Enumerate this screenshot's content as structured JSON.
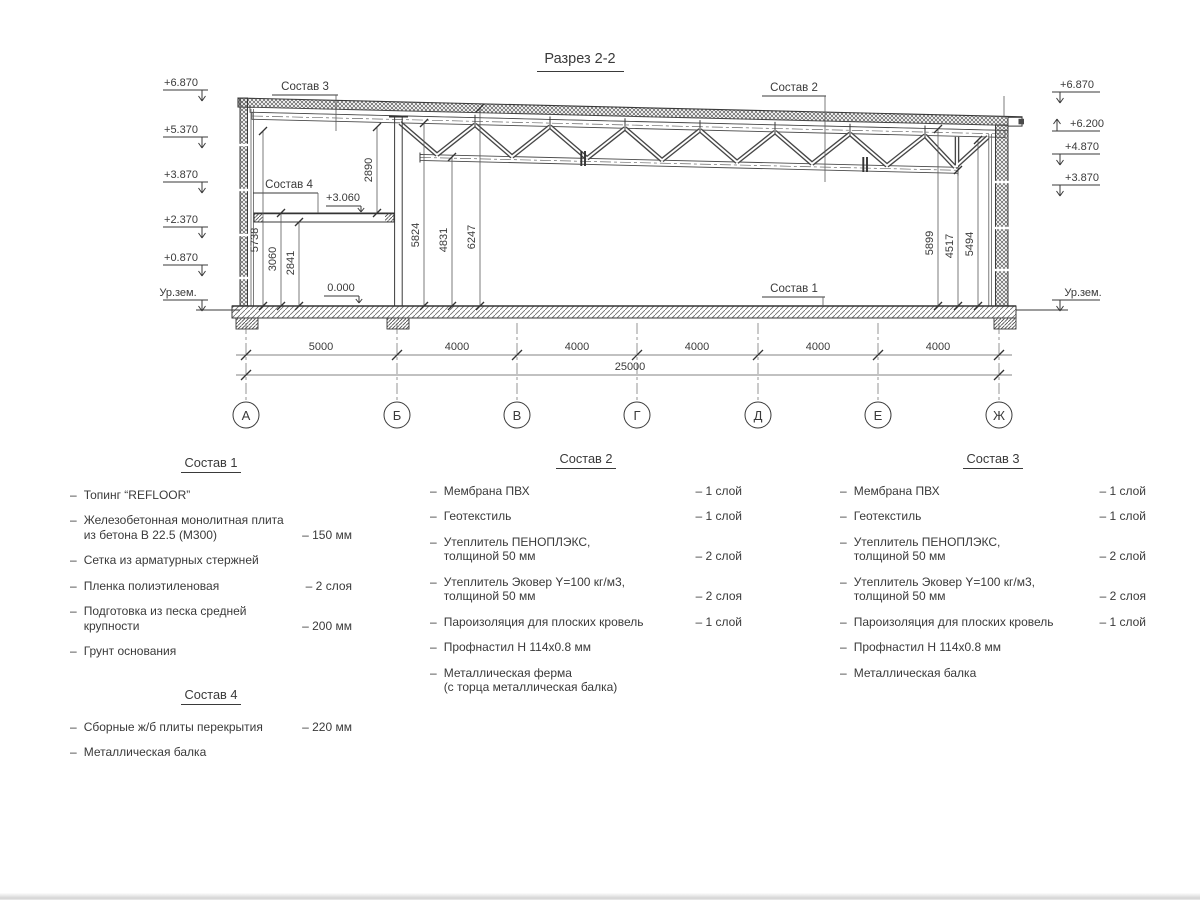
{
  "bullet": "–",
  "drawing": {
    "title": "Разрез 2-2",
    "elev_left": [
      "+6.870",
      "+5.370",
      "+3.870",
      "+2.370",
      "+0.870",
      "Ур.зем."
    ],
    "elev_right": [
      "+6.870",
      "+6.200",
      "+4.870",
      "+3.870",
      "Ур.зем."
    ],
    "inner_levels": [
      "+3.060",
      "0.000"
    ],
    "leaders": [
      "Состав 3",
      "Состав 4",
      "Состав 2",
      "Состав 1"
    ],
    "vdims": [
      "5738",
      "3060",
      "2841",
      "2890",
      "5824",
      "4831",
      "6247",
      "5899",
      "4517",
      "5494"
    ],
    "hdims": [
      "5000",
      "4000",
      "4000",
      "4000",
      "4000",
      "4000"
    ],
    "total_dim": "25000",
    "axes": [
      "А",
      "Б",
      "В",
      "Г",
      "Д",
      "Е",
      "Ж"
    ]
  },
  "compositions": [
    {
      "title": "Состав 1",
      "items": [
        {
          "text": "Топинг “REFLOOR”",
          "value": ""
        },
        {
          "text": "Железобетонная  монолитная плита\nиз бетона В 22.5 (М300)",
          "value": "– 150 мм"
        },
        {
          "text": "Сетка из арматурных стержней",
          "value": ""
        },
        {
          "text": "Пленка полиэтиленовая",
          "value": "– 2 слоя"
        },
        {
          "text": "Подготовка из песка средней\nкрупности",
          "value": "– 200 мм"
        },
        {
          "text": "Грунт основания",
          "value": ""
        }
      ]
    },
    {
      "title": "Состав 2",
      "items": [
        {
          "text": "Мембрана ПВХ",
          "value": "– 1 слой"
        },
        {
          "text": "Геотекстиль",
          "value": "– 1 слой"
        },
        {
          "text": "Утеплитель ПЕНОПЛЭКС,\nтолщиной 50 мм",
          "value": "– 2 слой"
        },
        {
          "text": "Утеплитель Эковер Y=100 кг/м3,\nтолщиной 50 мм",
          "value": "– 2 слоя"
        },
        {
          "text": "Пароизоляция для плоских кровель",
          "value": "– 1 слой"
        },
        {
          "text": "Профнастил Н 114х0.8 мм",
          "value": ""
        },
        {
          "text": "Металлическая ферма\n(с торца металлическая балка)",
          "value": ""
        }
      ]
    },
    {
      "title": "Состав 3",
      "items": [
        {
          "text": "Мембрана ПВХ",
          "value": "– 1 слой"
        },
        {
          "text": "Геотекстиль",
          "value": "– 1 слой"
        },
        {
          "text": "Утеплитель ПЕНОПЛЭКС,\nтолщиной 50 мм",
          "value": "– 2 слой"
        },
        {
          "text": "Утеплитель Эковер Y=100 кг/м3,\nтолщиной 50 мм",
          "value": "– 2 слоя"
        },
        {
          "text": "Пароизоляция для плоских кровель",
          "value": "– 1 слой"
        },
        {
          "text": "Профнастил Н 114х0.8 мм",
          "value": ""
        },
        {
          "text": "Металлическая балка",
          "value": ""
        }
      ]
    },
    {
      "title": "Состав 4",
      "items": [
        {
          "text": "Сборные ж/б плиты перекрытия",
          "value": "– 220 мм"
        },
        {
          "text": "Металлическая балка",
          "value": ""
        }
      ]
    }
  ]
}
